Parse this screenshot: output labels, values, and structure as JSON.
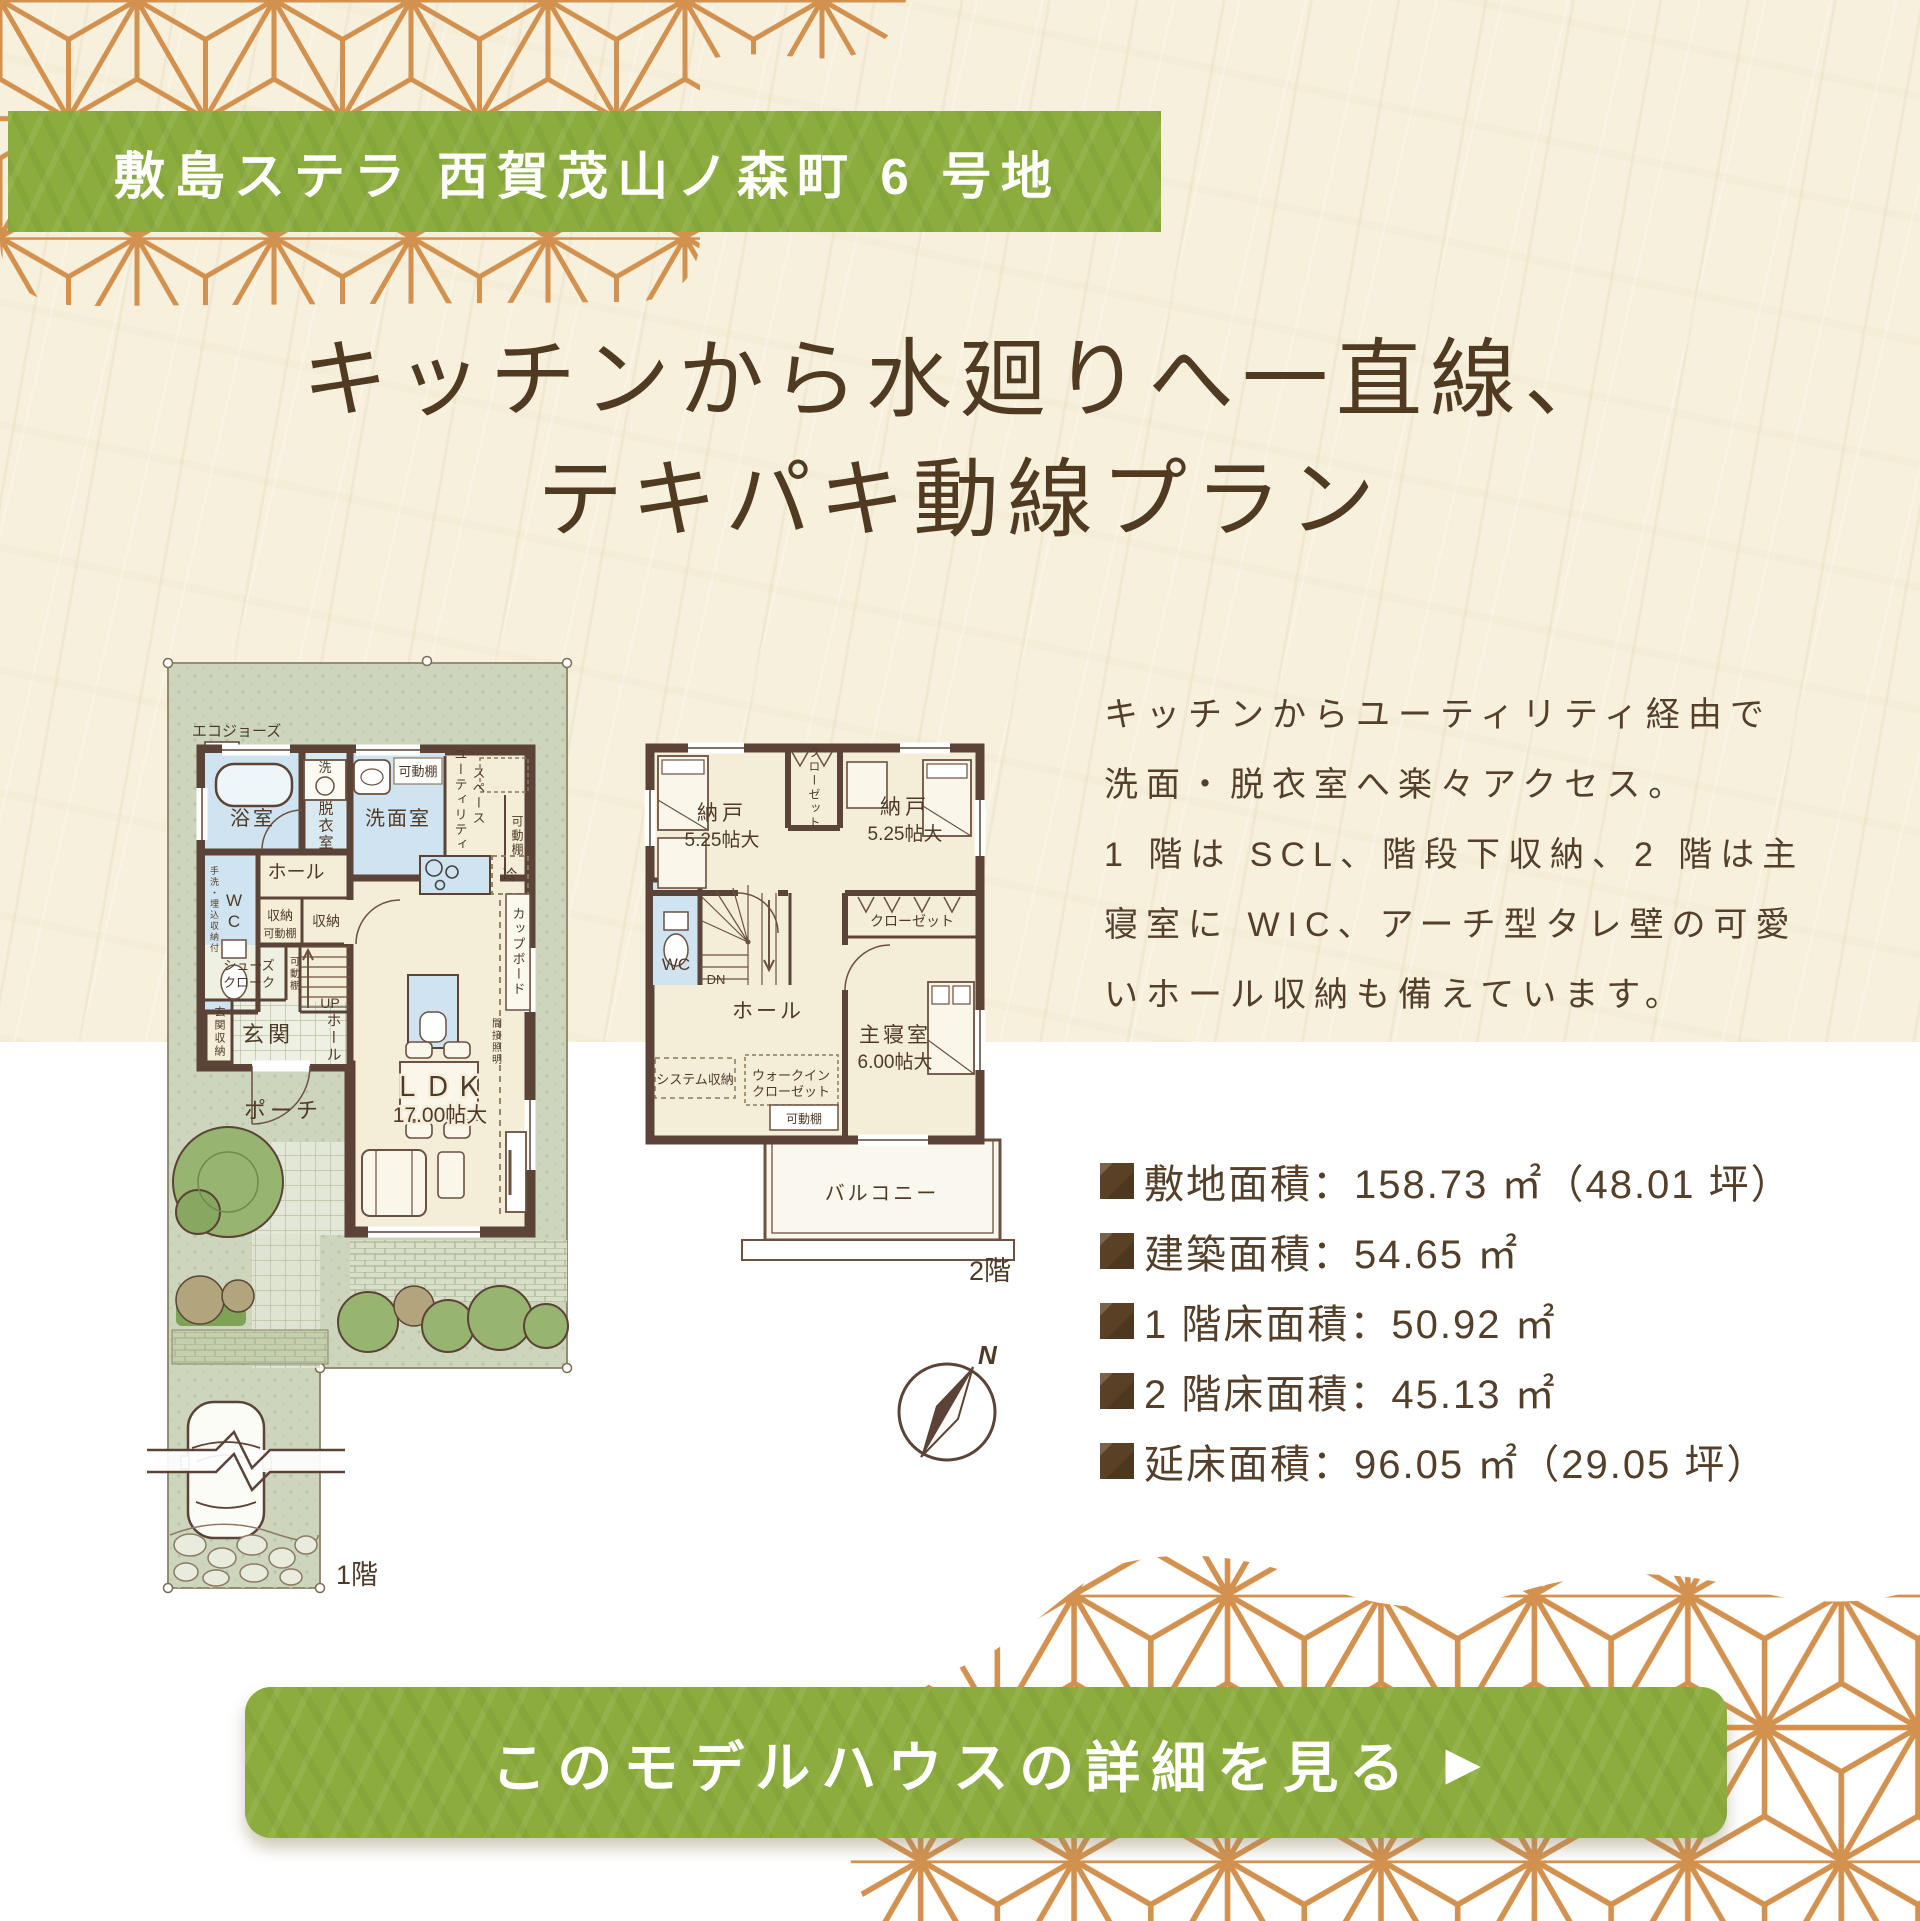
{
  "colors": {
    "background_beige": "#f6f0dc",
    "background_white": "#ffffff",
    "accent_green": "#8cad3e",
    "pattern_orange": "#d2914f",
    "text_brown": "#54402a",
    "wall_brown": "#5b4337",
    "water_blue": "#cfe4f0",
    "room_cream": "#f4eed8",
    "site_green": "#cdd6bd"
  },
  "banner": {
    "title": "敷島ステラ 西賀茂山ノ森町 6 号地"
  },
  "headline": {
    "line1": "キッチンから水廻りへ一直線、",
    "line2": "テキパキ動線プラン"
  },
  "description": {
    "lines": [
      "キッチンからユーティリティ経由で",
      "洗面・脱衣室へ楽々アクセス。",
      "1 階は SCL、階段下収納、2 階は主",
      "寝室に WIC、アーチ型タレ壁の可愛",
      "いホール収納も備えています。"
    ]
  },
  "specs": {
    "items": [
      "敷地面積：158.73 ㎡（48.01 坪）",
      "建築面積：54.65 ㎡",
      "1 階床面積：50.92 ㎡",
      "2 階床面積：45.13 ㎡",
      "延床面積：96.05 ㎡（29.05 坪）"
    ]
  },
  "cta": {
    "label": "このモデルハウスの詳細を見る",
    "arrow": "▶"
  },
  "floor1": {
    "caption": "1階",
    "eco": "エコジョーズ",
    "bath": "浴室",
    "wash": "洗",
    "dressing": "脱衣室",
    "lavatory": "洗面室",
    "shelf": "可動棚",
    "utility1": "ユーティリティ",
    "utility2": "スペース",
    "fridge": "冷",
    "cupboard": "カップボード",
    "wc": "WC",
    "wc_note": "手洗・埋込収納付",
    "hall": "ホール",
    "storage": "収納",
    "shoes1": "シューズ",
    "shoes2": "クローク",
    "up": "UP",
    "uphall": "ホール",
    "genkan": "玄関",
    "genkan_storage": "玄関収納",
    "porch": "ポーチ",
    "ldk": "ＬＤＫ",
    "ldk_size": "17.00帖大",
    "indirect": "間接照明"
  },
  "floor2": {
    "caption": "2階",
    "storage_label": "納戸",
    "storage_size": "5.25帖大",
    "closet": "クローゼット",
    "wc": "WC",
    "dn": "DN",
    "hall": "ホール",
    "master": "主寝室",
    "master_size": "6.00帖大",
    "system": "システム収納",
    "wic1": "ウォークイン",
    "wic2": "クローゼット",
    "shelf": "可動棚",
    "balcony": "バルコニー"
  },
  "compass": {
    "north": "N"
  }
}
